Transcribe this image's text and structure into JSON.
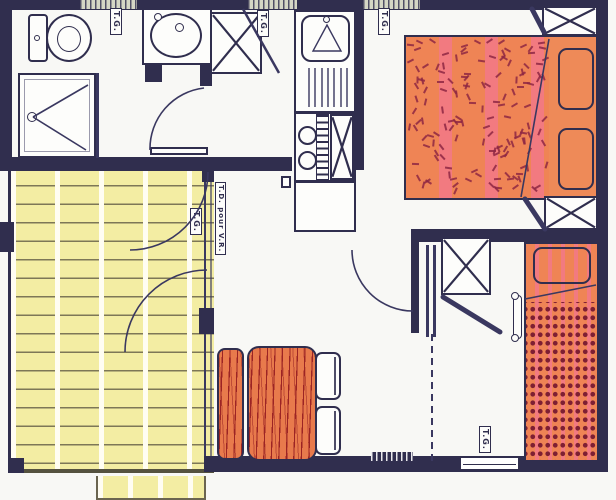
{
  "labels": {
    "tg_bathroom": "T.G.",
    "tg_hall": "T.G.",
    "tg_bedroom1": "T.G.",
    "tg_terrace": "T.G.",
    "tg_bedroom2": "T.G.",
    "td_pour_vr": "T.D. pour V.R."
  },
  "colors": {
    "wall": "#302e4e",
    "line": "#3a3860",
    "paper": "#f8f8f5",
    "room": "#fdfdfb",
    "terrace": "#f3eda3",
    "terrace_line": "#7d7757",
    "terrace_streak": "#fffdf2",
    "bed": "#ef8455",
    "bed_stripe": "#f27a80",
    "pillow_zone": "#ee8a58",
    "confetti": "#8e2743",
    "dots": "#7e1f33",
    "wood": "#e87a4c",
    "wood_grain": "#9c2424",
    "vent": "#d5d7c5",
    "window": "#ffffff"
  },
  "fixtures": [
    "toilet",
    "washbasin",
    "shower",
    "wardrobe",
    "kitchen-sink",
    "stove",
    "fridge",
    "double-bed",
    "single-bed",
    "dining-table",
    "bench",
    "chair",
    "terrace-deck",
    "door",
    "window"
  ],
  "rooms": [
    "bathroom",
    "hall",
    "kitchen",
    "bedroom-1",
    "bedroom-2",
    "living-dining",
    "terrace"
  ]
}
